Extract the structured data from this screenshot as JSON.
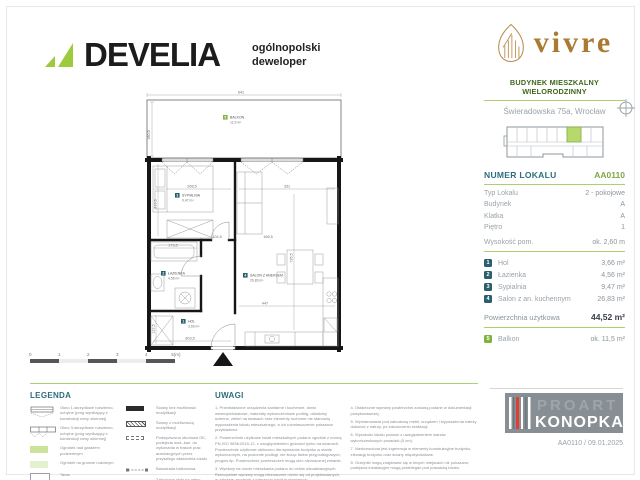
{
  "header": {
    "brand": "DEVELIA",
    "tagline1": "ogólnopolski",
    "tagline2": "deweloper"
  },
  "brand": {
    "name": "vivre",
    "building": "BUDYNEK MIESZKALNY WIELORODZINNY",
    "address": "Świeradowska 75a, Wrocław"
  },
  "unit": {
    "label": "NUMER LOKALU",
    "number": "AA0110",
    "attributes": [
      {
        "label": "Typ Lokalu",
        "value": "2 - pokojowe"
      },
      {
        "label": "Budynek",
        "value": "A"
      },
      {
        "label": "Klatka",
        "value": "A"
      },
      {
        "label": "Piętro",
        "value": "1"
      }
    ],
    "height": {
      "label": "Wysokość pom.",
      "value": "ok. 2,60 m"
    },
    "rooms": [
      {
        "no": "1",
        "name": "Hol",
        "area": "3,66 m²"
      },
      {
        "no": "2",
        "name": "Łazienka",
        "area": "4,56 m²"
      },
      {
        "no": "3",
        "name": "Sypialnia",
        "area": "9,47 m²"
      },
      {
        "no": "4",
        "name": "Salon z an. kuchennym",
        "area": "26,83 m²"
      }
    ],
    "total": {
      "label": "Powierzchnia użytkowa",
      "value": "44,52 m²"
    },
    "balcony": {
      "no": "5",
      "name": "Balkon",
      "area": "ok. 11,5 m²"
    }
  },
  "plan": {
    "rooms": [
      {
        "no": "5",
        "name": "BALKON",
        "area": "11,5 m²"
      },
      {
        "no": "3",
        "name": "SYPIALNIA",
        "area": "9,47 m²"
      },
      {
        "no": "2",
        "name": "ŁAZIENKA",
        "area": "4,56 m²"
      },
      {
        "no": "1",
        "name": "HOL",
        "area": "3,66 m²"
      },
      {
        "no": "4",
        "name": "SALON Z ANEKSEM",
        "area": "26,83 m²"
      }
    ],
    "dims": {
      "balcony_width": "641",
      "balcony_depth": "180,5",
      "bedroom_width": "268,5",
      "bedroom_height": "319,5",
      "salon_width": "331",
      "mid_left": "104,5",
      "mid_right": "166,5",
      "bath_width": "173,5",
      "salon_inner": "447",
      "salon_height": "735,5",
      "hol_width": "303,5",
      "hol_height": "122,5"
    }
  },
  "scalebar": {
    "ticks": [
      "0",
      "1",
      "2",
      "3",
      "4",
      "5(m)"
    ]
  },
  "legend": {
    "title": "LEGENDA",
    "left": [
      {
        "text": "Okno 1-skrzydłowe rozwierno-uchylne (próg wynikający z konstrukcji ramy okiennej)"
      },
      {
        "text": "Okno 3-skrzydłowe rozwierno-uchylne (próg wynikający z konstrukcji ramy okiennej)"
      },
      {
        "text": "Ogródek nad garażem podziemnym"
      },
      {
        "text": "Ogródek na gruncie rodzimym"
      },
      {
        "text": "Taras"
      }
    ],
    "right": [
      {
        "text": "Ściany bez możliwości modyfikacji"
      },
      {
        "text": "Ściany z możliwością modyfikacji"
      },
      {
        "text": "Podwyższona obudowa GK, podejścia wod.-kan. do wykonania w trakcie prac aranżacyjnych przez przyszłego właściciela lokalu"
      },
      {
        "text": "Balustrada balkonowa"
      },
      {
        "text": "Zabudowa płyty na pełną wysokość"
      }
    ]
  },
  "uwagi": {
    "title": "UWAGI",
    "col1": [
      "1. Przedstawione urządzenia sanitarne i kuchenne, drzwi wewnątrzlokalowe, materiały wykończeniowe podłóg, okładziny ścienne, zieleń na tarasach oraz elementy ruchome nie stanowią wyposażenia lokalu mieszkalnego, a ich rozmieszczenie pokazano przykładowo.",
      "2. Powierzchnie użytkowe lokali mieszkalnych podano zgodnie z normą PN-ISO 9836:2015-12, z uwzględnieniem grubości tynku na ścianach. Powierzchnie użytkowe obliczono dla wymiarów budynku w stanie wykończonym, na poziomie podłogi, nie licząc listew przypodłogowych, progów itp. Powierzchnie pomieszczeń mogą ulec nieznacznej zmianie.",
      "3. Wymiary na rzucie mieszkania podano do celów wizualizacyjnych. Rzeczywiste wymiary mogą nieznacznie różnić się od projektowanych, w zakresie zgodnym z tolerancją robót budowlanych."
    ],
    "col2": [
      "4. Ostateczne wymiary powierzchni zostaną podane w dokumentacji powykonawczej.",
      "5. Wymiarowania pod zabudowę mebli, urządzeń i wyposażenia należy dokonać z natury, po zakończeniu realizacji.",
      "6. Wysokość lokalu podano z uwzględnieniem warstw wykończeniowych posadzki (5 cm).",
      "7. Niedozwolona jest ingerencja w elementy konstrukcyjne budynku, elewację budynku oraz ściany międzylokalowe.",
      "8. Grzejniki mogą znajdować się w innych miejscach niż pokazano; podejścia instalacyjne mogą przebiegać pod posadzką lokalu."
    ]
  },
  "stamp": {
    "top": "PROART",
    "bottom": "KONOPKA"
  },
  "footer": {
    "doc": "AA0110 / 09.01.2025"
  },
  "colors": {
    "develia_green": "#9CCB3B",
    "brand_brown": "#A97A2F",
    "teal": "#2C6E7D",
    "unit_green": "#7FA744",
    "divider_green": "#AECF6F",
    "stamp_red": "#E04033"
  }
}
